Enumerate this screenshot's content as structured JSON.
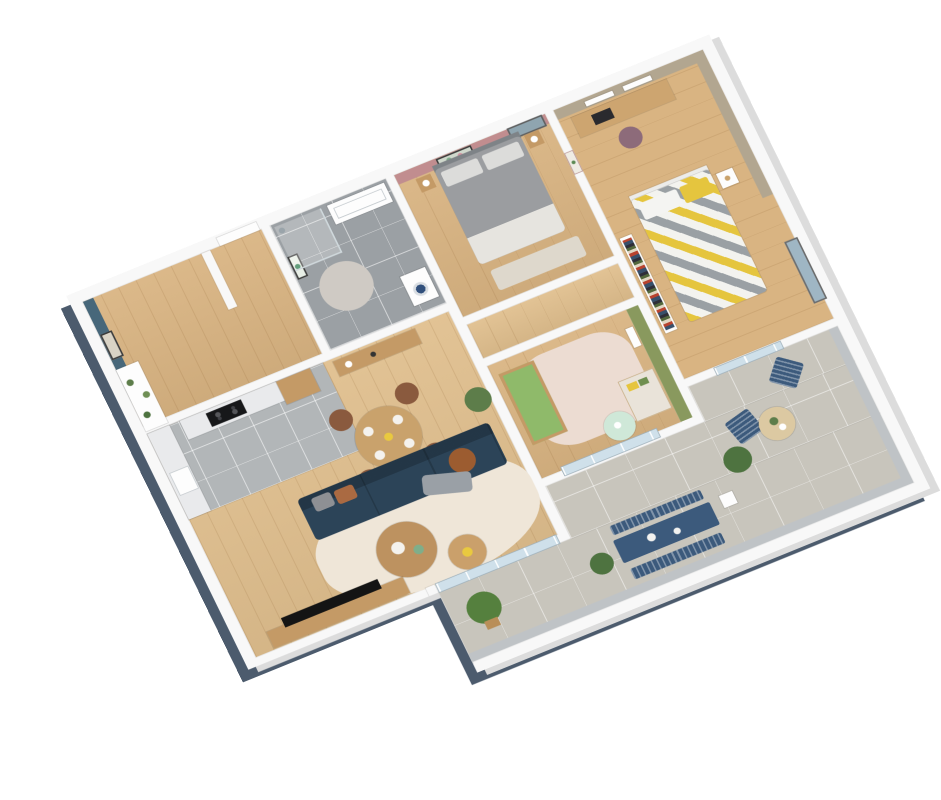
{
  "scene": {
    "type": "3d-floor-plan-render",
    "description": "Axonometric 3D cutaway floor plan of an apartment with wraparound terrace, white walls, oak floors",
    "view_rotation_deg": -24,
    "background": "#ffffff"
  },
  "palette": {
    "wall_white": "#f8f8f8",
    "wall_shadow_dark": "#4c5b6d",
    "wall_side_gray": "#dcdcdc",
    "wood_floor": "#d9b482",
    "wood_floor_light": "#e0bf8e",
    "tile_bathroom": "#9ba0a4",
    "tile_kitchen": "#b2b6b8",
    "tile_terrace": "#c8c5bc",
    "accent_teal": "#47677a",
    "accent_pink": "#c18d8f",
    "accent_taupe": "#b2a690",
    "accent_green": "#89995e",
    "sofa_teal": "#2c4458",
    "pillow_rust": "#aa6a42",
    "pillow_gray": "#8e9094",
    "wood_furniture": "#c49a66",
    "table_wood": "#c9a26c",
    "chair_brown": "#8a5a3e",
    "outdoor_blue": "#3c5a7c",
    "bed_gray": "#9b9da0",
    "chevron_yellow": "#e5c53e",
    "rug_cream": "#efe6d8",
    "rug_nursery": "#ecdcd2",
    "rug_bath": "#cfcac4",
    "crib_green": "#8fba6a",
    "mint": "#cfe8d8",
    "marble": "#e9eaec",
    "cooktop_black": "#17181a",
    "tv_black": "#141414",
    "plant_green": "#5d7d4a",
    "boxwood_green": "#4e7340",
    "terrace_table_wood": "#dcc9a2",
    "chair_mauve": "#8d6b7a",
    "glass_blue": "#cfe0ea",
    "window_frame": "#6c6c6c"
  },
  "rooms": [
    {
      "name": "entry-hall",
      "floor": "wood",
      "accent_wall": "#47677a",
      "furniture": [
        "abstract-line-artwork",
        "console-shelving-with-plants",
        "front-door"
      ]
    },
    {
      "name": "kitchen",
      "floor": "gray-tile",
      "accent_wall": null,
      "furniture": [
        "marble-counter",
        "induction-cooktop",
        "oven",
        "sink",
        "tall-wood-cabinet",
        "open-shelving",
        "sideboard-with-lamp"
      ]
    },
    {
      "name": "living-dining-room",
      "floor": "wood",
      "accent_wall": null,
      "furniture": [
        "round-dining-table",
        "4-brown-chairs",
        "teal-sofa",
        "rust-and-gray-pillows",
        "nesting-coffee-tables",
        "cream-rug",
        "tv-console",
        "tv",
        "potted-plant",
        "sliding-glass-door"
      ]
    },
    {
      "name": "bathroom",
      "floor": "gray-tile",
      "accent_wall": null,
      "furniture": [
        "walk-in-shower",
        "vanity-sink",
        "washing-machine",
        "round-rug",
        "leaf-artwork"
      ]
    },
    {
      "name": "master-bedroom",
      "floor": "wood",
      "accent_wall": "#c18d8f",
      "furniture": [
        "double-bed-gray",
        "two-nightstands",
        "lamps",
        "colorful-artwork",
        "window",
        "cactus-artwork",
        "foot-rug"
      ]
    },
    {
      "name": "second-bedroom",
      "floor": "wood",
      "accent_wall": "#b2a690",
      "furniture": [
        "desk-with-laptop",
        "mauve-desk-chair",
        "wall-shelves",
        "bookshelf",
        "single-bed-chevron-yellow-gray",
        "nightstand",
        "window"
      ]
    },
    {
      "name": "nursery",
      "floor": "wood",
      "accent_wall": "#89995e",
      "furniture": [
        "wooden-crib-green-mattress",
        "dresser",
        "yellow-storage-boxes",
        "mint-side-table",
        "wall-shelf",
        "pink-rug",
        "sliding-glass-door"
      ]
    },
    {
      "name": "corridor",
      "floor": "wood",
      "accent_wall": null,
      "furniture": [
        "doors"
      ]
    },
    {
      "name": "terrace",
      "floor": "stone-tile",
      "accent_wall": null,
      "furniture": [
        "blue-outdoor-dining-table",
        "two-blue-benches",
        "two-blue-lounge-chairs",
        "round-outdoor-table",
        "boxwood-shrubs",
        "potted-tree",
        "metal-railing",
        "white-parapet"
      ]
    }
  ]
}
